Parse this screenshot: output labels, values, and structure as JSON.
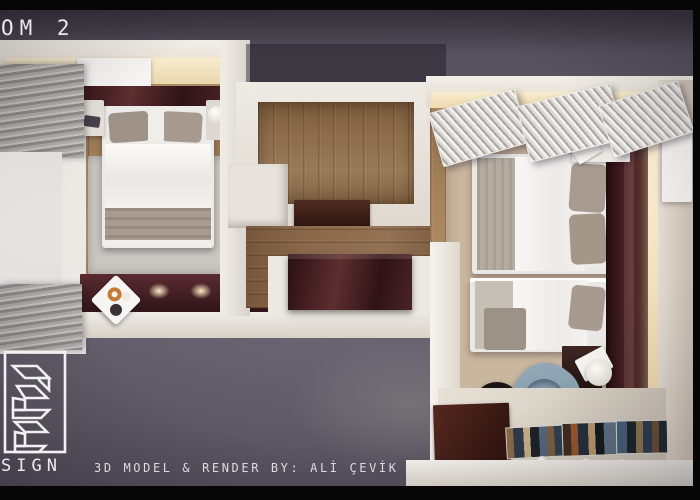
{
  "overlay": {
    "title": "OM 2",
    "credit": "3D MODEL & RENDER BY: ALİ ÇEVİK",
    "logo_text": "SIGN"
  },
  "colors": {
    "backdrop": "#605c68",
    "letterbox": "#060606",
    "wall_white": "#efece6",
    "wood_floor": "#9e7e58",
    "corridor_floor": "#8a684a",
    "mahogany_furniture": "#442125",
    "bedding_white": "#f3f2f0",
    "pillow_taupe": "#a79a8f",
    "rug_left_gray": "#c9c6c1",
    "rug_right_beige": "#c8b59d",
    "armchair_blue": "#8aa0b2",
    "warm_light_glow": "#f6e8c9"
  }
}
